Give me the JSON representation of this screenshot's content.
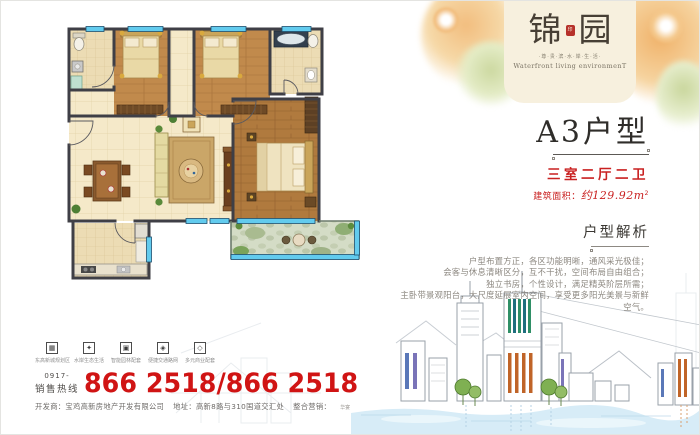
{
  "brand": {
    "name_left": "锦",
    "name_right": "园",
    "seal": "印",
    "tagline": "·尊·贵·滨·水·岸·生·活·",
    "tagline_en": "Waterfront living environmenT"
  },
  "unit": {
    "title": "A3户型",
    "layout": "三室二厅二卫",
    "area_label": "建筑面积：",
    "area_value": "约129.92m",
    "area_sup": "2"
  },
  "analysis": {
    "heading": "户型解析",
    "lines": [
      "户型布置方正，各区功能明晰，通风采光极佳；",
      "会客与休息清晰区分，互不干扰，空间布局自由组合；",
      "独立书房，个性设计，满足精英阶层所需；",
      "主卧带景观阳台，大尺度延展室内空间，享受更多阳光美景与新鲜空气。"
    ]
  },
  "features": [
    {
      "icon": "city-district-icon",
      "glyph": "▦",
      "label": "东高新城规划区"
    },
    {
      "icon": "eco-waterfront-icon",
      "glyph": "✦",
      "label": "水岸生态生活"
    },
    {
      "icon": "garden-icon",
      "glyph": "▣",
      "label": "智能园林配套"
    },
    {
      "icon": "traffic-icon",
      "glyph": "◈",
      "label": "便捷交通路网"
    },
    {
      "icon": "business-icon",
      "glyph": "◇",
      "label": "多元商业配套"
    }
  ],
  "hotline": {
    "area_code": "0917-",
    "label": "销售热线",
    "number": "866 2518/866 2518"
  },
  "footer": {
    "developer": "开发商：宝鸡高新房地产开发有限公司",
    "address": "地址：高新8路与310国道交汇处",
    "marketing_label": "整合营销：",
    "marketing_logo": "华宴"
  },
  "colors": {
    "accent_red": "#d01414",
    "panel_cream": "#f7f0de",
    "window_cyan": "#62cbee"
  }
}
